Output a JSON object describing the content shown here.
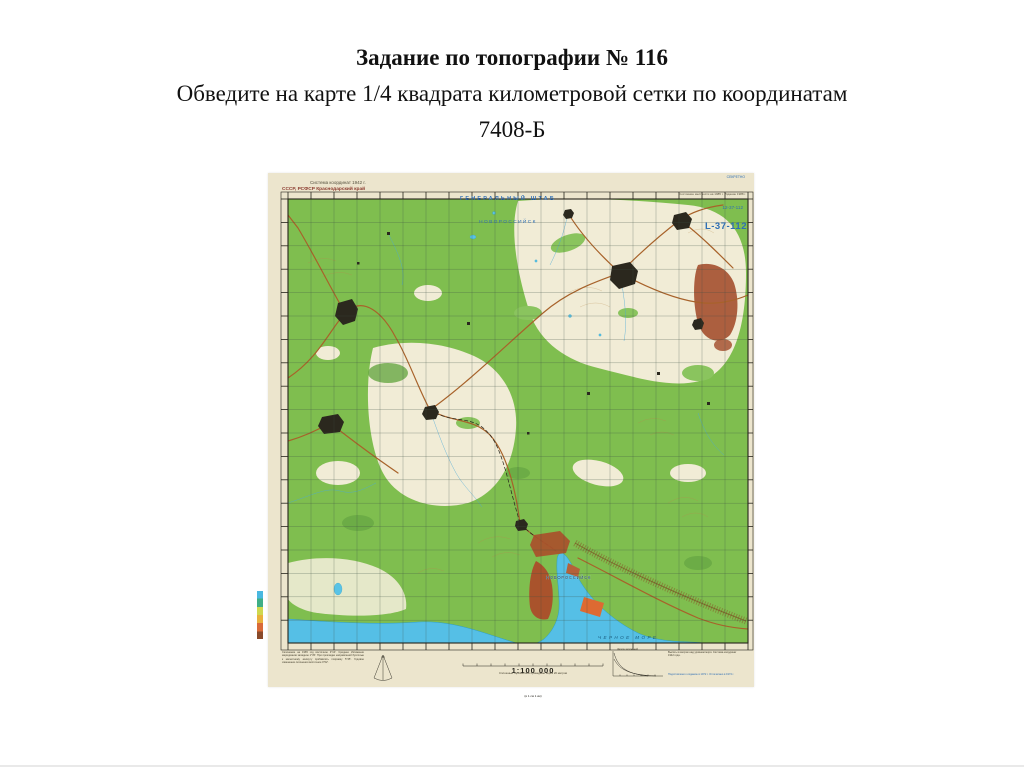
{
  "title": {
    "line1": "Задание по топографии № 116",
    "line2": "Обведите на карте  1/4 квадрата километровой сетки по координатам",
    "line3": "7408-Б"
  },
  "map": {
    "header": {
      "coord_system": "Система координат 1942 г.",
      "country": "СССР, РСФСР Краснодарский край",
      "agency": "ГЕНЕРАЛЬНЫЙ ШТАБ",
      "sheet_name": "НОВОРОССИЙСК",
      "secrecy": "СЕКРЕТНО",
      "series_code": "12-37-112",
      "sheet_code": "L-37-112",
      "state_note": "Состояние местности на 1985 г. Издание 1988 г."
    },
    "footer": {
      "scale": "1:100 000",
      "scale_sub": "(в 1 см 1 км)",
      "contour_note": "Сплошные горизонтали проведены через 20 метров",
      "declination_note": "Склонение на 1965 год восточное 4°10′. Среднее сближение меридианов западное 1°35′. При прокладке направлений буссолью к магнитному азимуту прибавлять поправку 5°45′. Годовое изменение склонения восточное 0°02′.",
      "slope_label": "Шкала заложений",
      "right_note": "Высоты в метрах над уровнем моря. Система координат 1942 года.",
      "print_note": "Подготовлено к изданию в 1972 г. Отпечатано в 1974 г."
    },
    "labels": {
      "city": "НОВОРОССИЙСК",
      "sea": "ЧЕРНОЕ МОРЕ"
    },
    "colors": {
      "paper": "#ece5cd",
      "forest_green": "#7fbe4f",
      "clearing": "#f1ecd6",
      "water": "#55bfe6",
      "urban_red": "#a9532c",
      "urban_orange": "#dd6a32",
      "road_brown": "#a8622a",
      "header_blue": "#2f6fb5",
      "town_black": "#2b281e"
    }
  }
}
